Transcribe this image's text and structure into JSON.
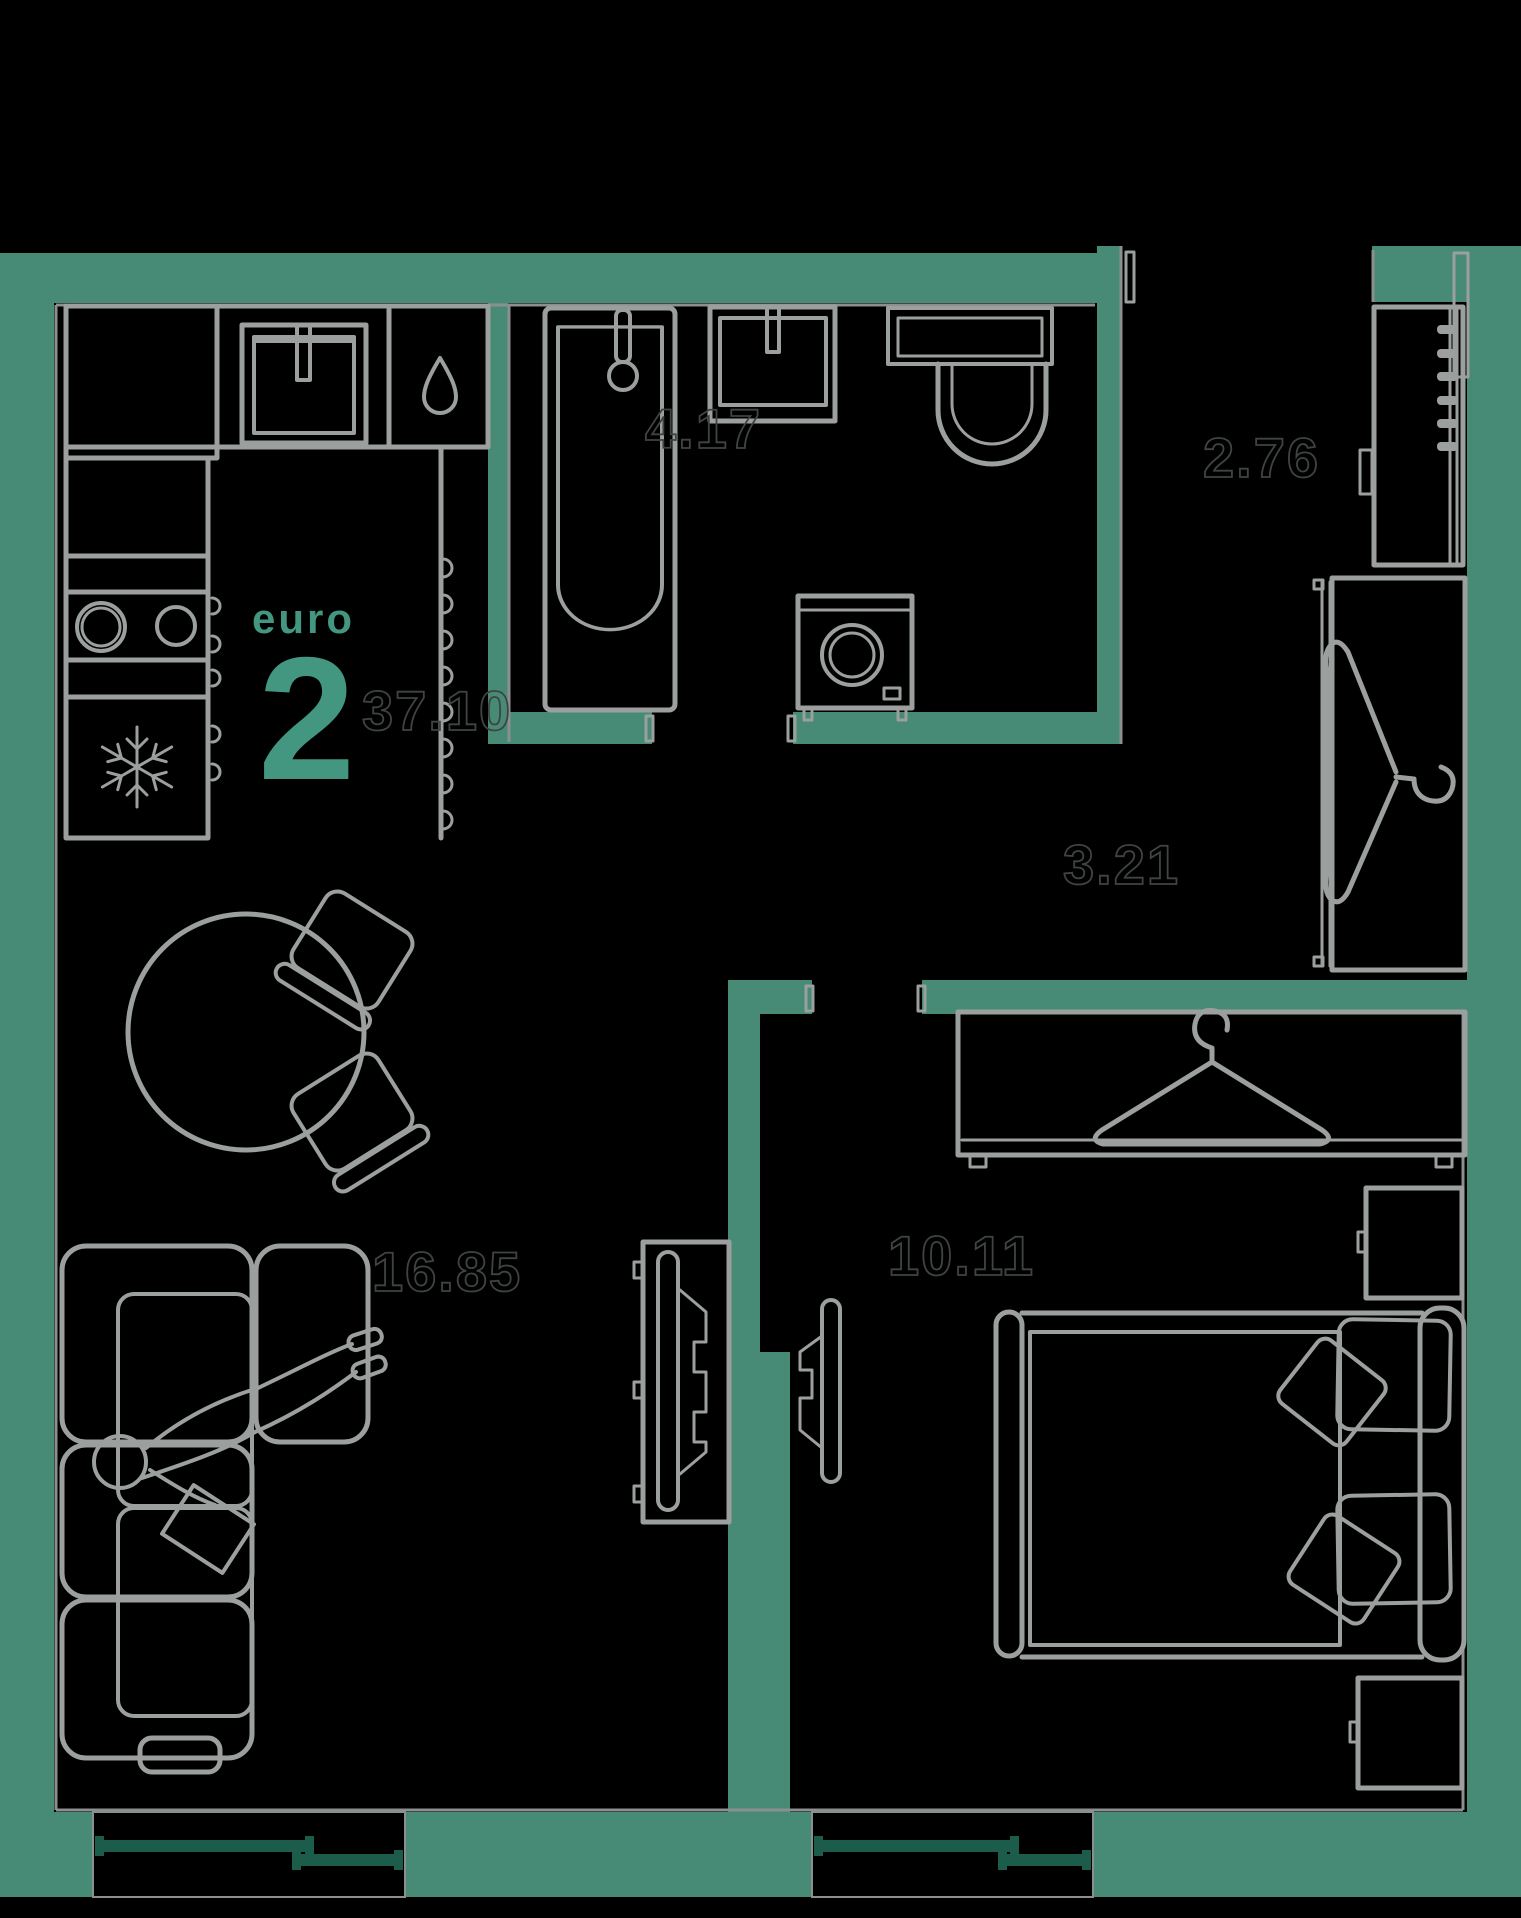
{
  "plan": {
    "unit": {
      "type_label": "euro",
      "rooms_count": "2",
      "total_area": "37.10"
    },
    "areas": {
      "bathroom": "4.17",
      "entry_hall": "2.76",
      "corridor": "3.21",
      "kitchen_living": "16.85",
      "bedroom": "10.11"
    },
    "colors": {
      "background": "#000000",
      "wall": "#478b76",
      "furniture_line": "#9b9f9e",
      "face_line": "#8b8f8e",
      "area_number": "#3f4442",
      "accent": "#43967f",
      "window_frame": "#1c5c4a"
    }
  }
}
